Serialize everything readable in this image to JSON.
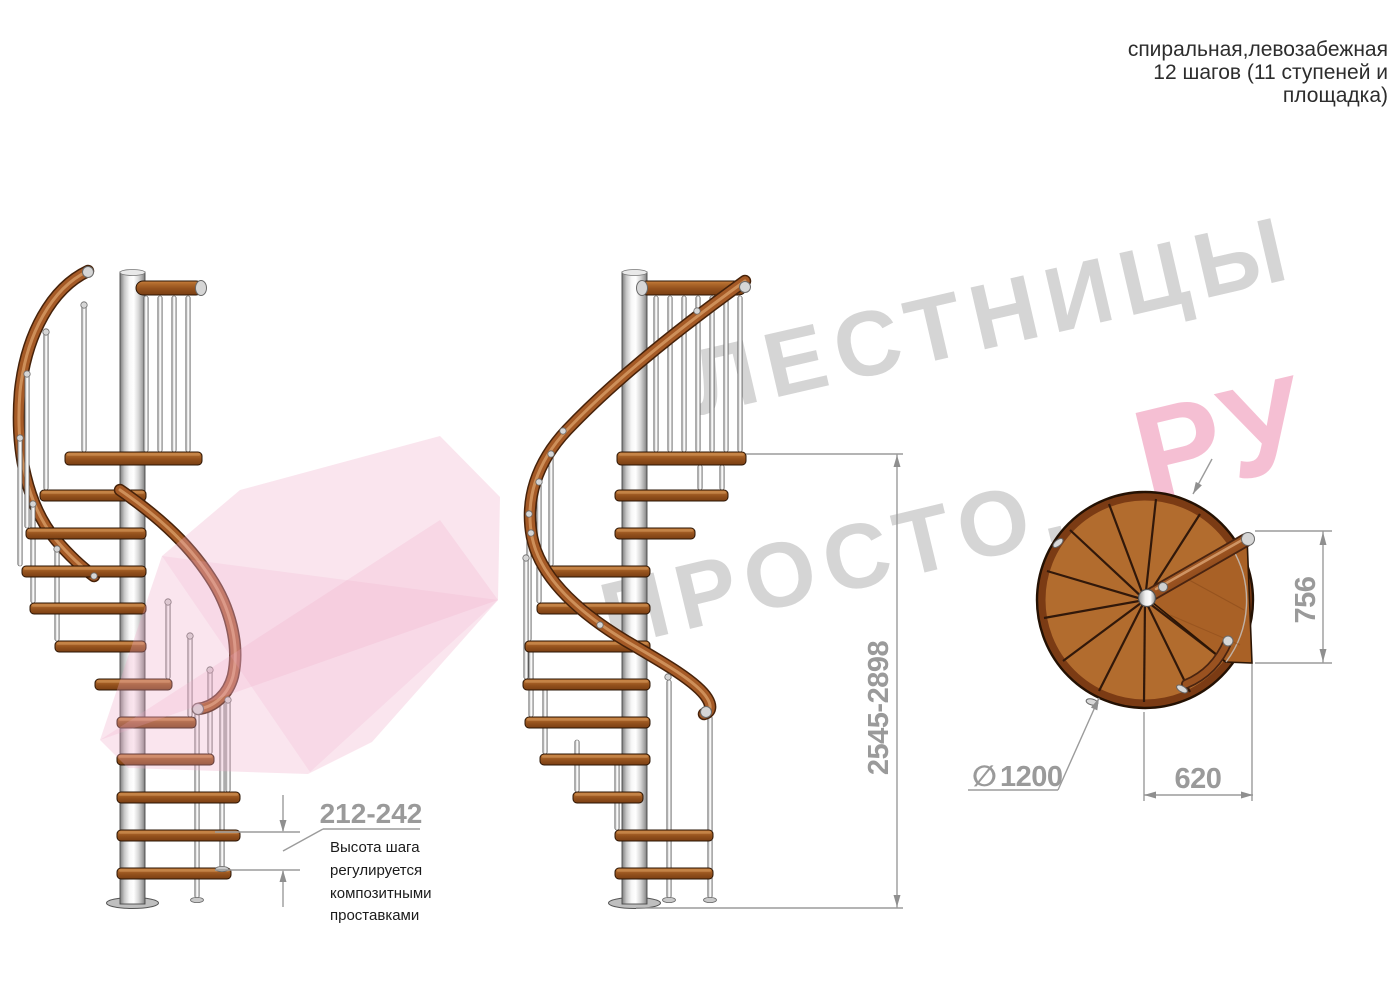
{
  "annotation": {
    "lines": [
      "спиральная,левозабежная",
      "12 шагов (11 ступеней и",
      "площадка)"
    ]
  },
  "watermark": {
    "brand_line1": "ЛЕСТНИЦЫ",
    "brand_line2": "ПРОСТО.",
    "brand_suffix": "РУ",
    "gray": "#cbcbcb",
    "pink": "#f5b9cf"
  },
  "dimensions": {
    "step_height": "212-242",
    "step_height_note": [
      "Высота шага",
      "регулируется",
      "композитными",
      "проставками"
    ],
    "total_height": "2545-2898",
    "landing_depth": "756",
    "landing_width": "620",
    "diameter_symbol": "∅",
    "diameter": "1200"
  },
  "colors": {
    "wood": "#a55a26",
    "wood_dark": "#6b3610",
    "metal": "#d9d9d9",
    "dimension_gray": "#9a9a9a",
    "note_text": "#1b1b1b",
    "watermark_gray": "#cbcbcb",
    "watermark_pink": "#f5b9cf"
  }
}
